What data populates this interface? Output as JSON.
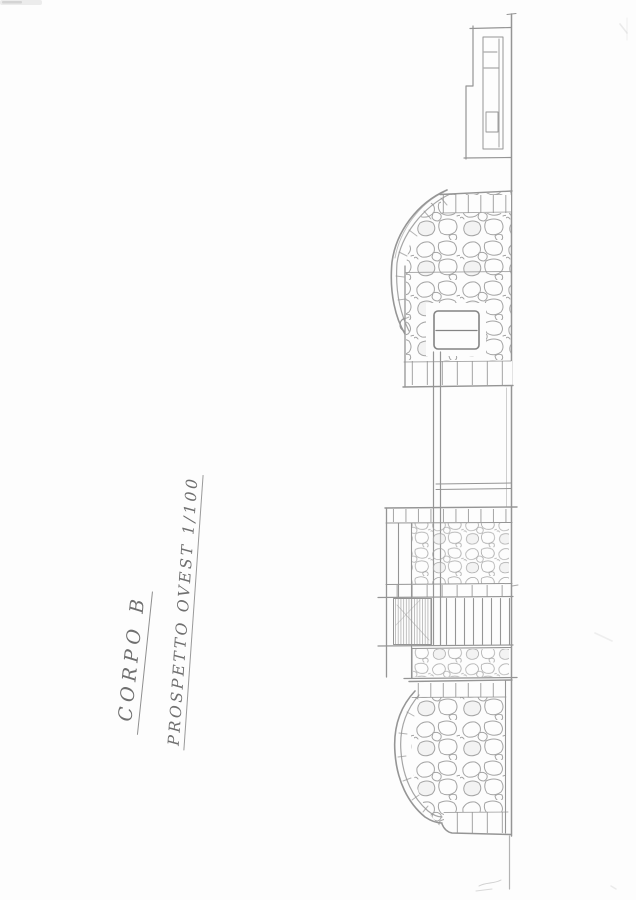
{
  "annotations": {
    "title": "CORPO B",
    "subtitle": "PROSPETTO OVEST 1/100"
  },
  "colors": {
    "paper": "#fdfdfd",
    "pencil": "#8c8c8c",
    "pencil_dark": "#757575",
    "pencil_light": "#ababab",
    "handwriting": "#6f6f6f"
  }
}
